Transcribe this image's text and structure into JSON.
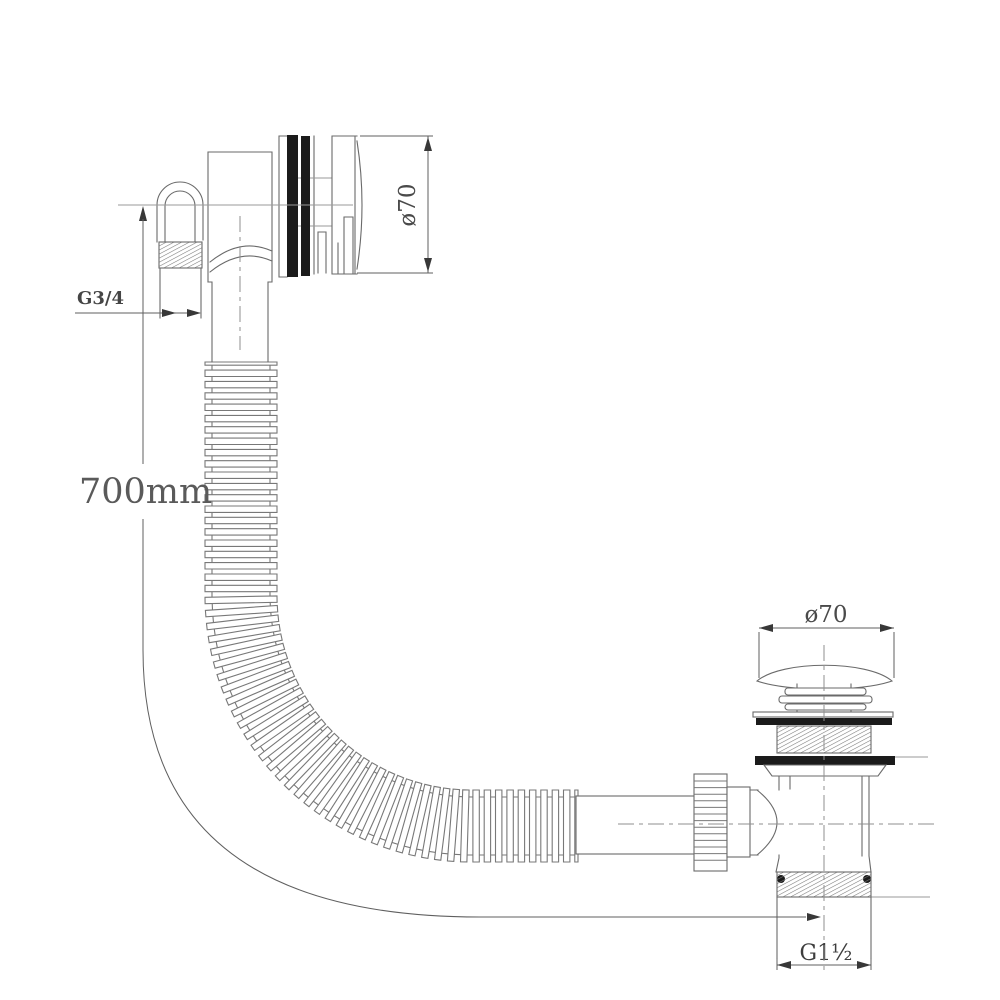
{
  "labels": {
    "hose_length": "700mm",
    "overflow_thread_size": "G3/4",
    "overflow_cap_diameter": "ø70",
    "waste_cap_diameter": "ø70",
    "waste_outlet_thread_size": "G1½"
  },
  "colors": {
    "background": "#ffffff",
    "line": "#6a6a6a",
    "dark_fill": "#1b1b1b",
    "text": "#4a4a4a"
  }
}
